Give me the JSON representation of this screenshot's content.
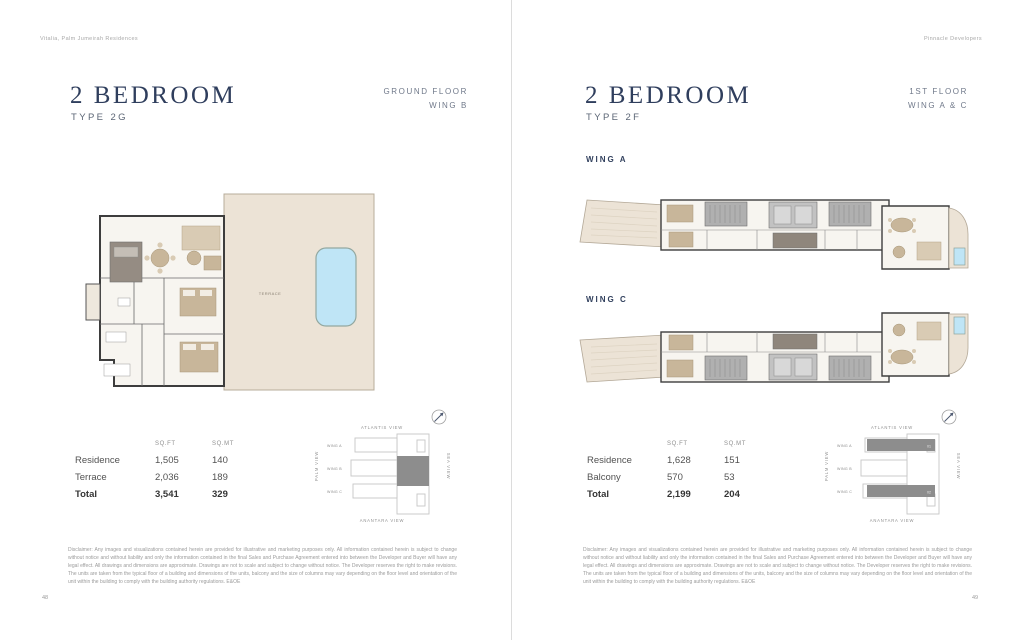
{
  "disclaimer": "Disclaimer: Any images and visualizations contained herein are provided for illustrative and marketing purposes only. All information contained herein is subject to change without notice and without liability and only the information contained in the final Sales and Purchase Agreement entered into between the Developer and Buyer will have any legal effect. All drawings and dimensions are approximate. Drawings are not to scale and subject to change without notice. The Developer reserves the right to make revisions. The units are taken from the typical floor of a building and dimensions of the units, balcony and the size of columns may vary depending on the floor level and orientation of the unit within the building to comply with the building authority regulations. E&OE",
  "colors": {
    "accent_navy": "#2f3e5d",
    "terrace_beige": "#ece3d6",
    "pool_blue": "#bfe5f6",
    "highlight_gray": "#8d8d8d"
  },
  "pages": [
    {
      "header": "Vitalia, Palm Jumeirah Residences",
      "title": "2 BEDROOM",
      "subtitle": "TYPE 2G",
      "floor": "GROUND FLOOR",
      "wing": "WING B",
      "plan": {
        "terrace_label": "TERRACE"
      },
      "table": {
        "col_headers": [
          "SQ.FT",
          "SQ.MT"
        ],
        "rows": [
          {
            "label": "Residence",
            "sqft": "1,505",
            "sqmt": "140"
          },
          {
            "label": "Terrace",
            "sqft": "2,036",
            "sqmt": "189"
          },
          {
            "label": "Total",
            "sqft": "3,541",
            "sqmt": "329"
          }
        ]
      },
      "compass": {
        "top": "ATLANTIS VIEW",
        "bottom": "ANANTARA VIEW",
        "left": "PALM VIEW",
        "right": "SEA VIEW",
        "wings": [
          "WING A",
          "WING B",
          "WING C"
        ]
      },
      "page_number": "48"
    },
    {
      "header": "Pinnacle Developers",
      "title": "2 BEDROOM",
      "subtitle": "TYPE 2F",
      "floor": "1ST FLOOR",
      "wing": "WING A & C",
      "sections": [
        {
          "label": "WING A"
        },
        {
          "label": "WING C"
        }
      ],
      "table": {
        "col_headers": [
          "SQ.FT",
          "SQ.MT"
        ],
        "rows": [
          {
            "label": "Residence",
            "sqft": "1,628",
            "sqmt": "151"
          },
          {
            "label": "Balcony",
            "sqft": "570",
            "sqmt": "53"
          },
          {
            "label": "Total",
            "sqft": "2,199",
            "sqmt": "204"
          }
        ]
      },
      "compass": {
        "top": "ATLANTIS VIEW",
        "bottom": "ANANTARA VIEW",
        "left": "PALM VIEW",
        "right": "SEA VIEW",
        "wings": [
          "WING A",
          "WING B",
          "WING C"
        ],
        "unit_tags": [
          "01",
          "02"
        ]
      },
      "page_number": "49"
    }
  ]
}
